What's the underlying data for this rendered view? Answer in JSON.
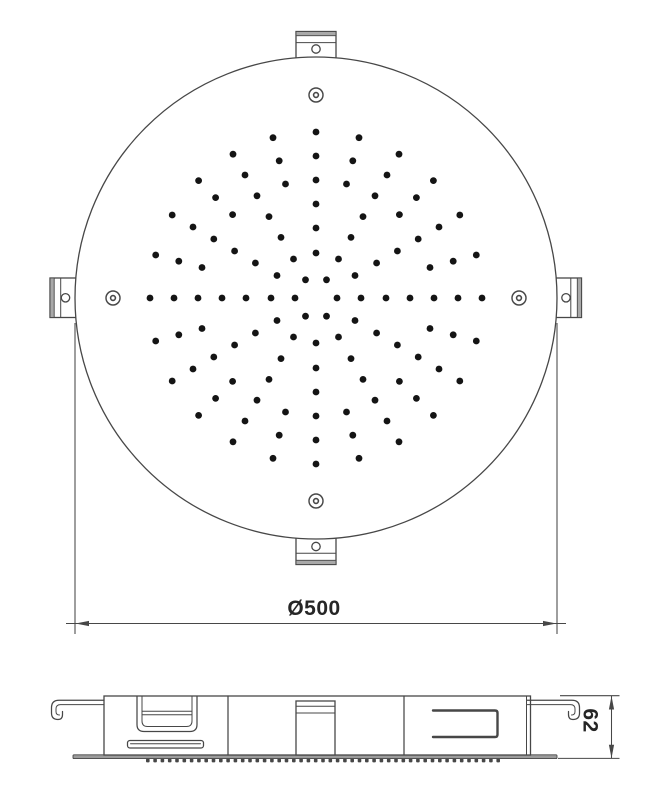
{
  "drawing": {
    "type": "shower-head-technical-drawing",
    "dimensions": {
      "diameter_label": "Ø500",
      "height_label": "62"
    },
    "nozzle_pattern": {
      "center": {
        "x": 316,
        "y": 298
      },
      "dot_radius": 3.4,
      "rings": [
        {
          "radius": 21,
          "count": 6,
          "start_angle_deg": 0
        },
        {
          "radius": 45,
          "count": 12,
          "start_angle_deg": 0
        },
        {
          "radius": 70,
          "count": 12,
          "start_angle_deg": 0
        },
        {
          "radius": 94,
          "count": 12,
          "start_angle_deg": 0
        },
        {
          "radius": 118,
          "count": 24,
          "start_angle_deg": 0
        },
        {
          "radius": 142,
          "count": 24,
          "start_angle_deg": 0
        },
        {
          "radius": 166,
          "count": 24,
          "start_angle_deg": 0
        }
      ]
    },
    "screw_holes": {
      "distance_from_center": 203,
      "angles_deg": [
        0,
        90,
        180,
        270
      ],
      "outer_radius": 7,
      "inner_radius": 2.4
    },
    "nozzle_tips": {
      "x_start": 146,
      "x_end": 500,
      "spacing": 7.3,
      "width": 3.6,
      "height": 3.8,
      "y": 758.6
    },
    "colors": {
      "background": "#ffffff",
      "line": "#474747",
      "dot": "#141414",
      "flange_fill": "#a9a9a9",
      "plate_fill": "#9c9c9c",
      "text": "#262626"
    }
  }
}
